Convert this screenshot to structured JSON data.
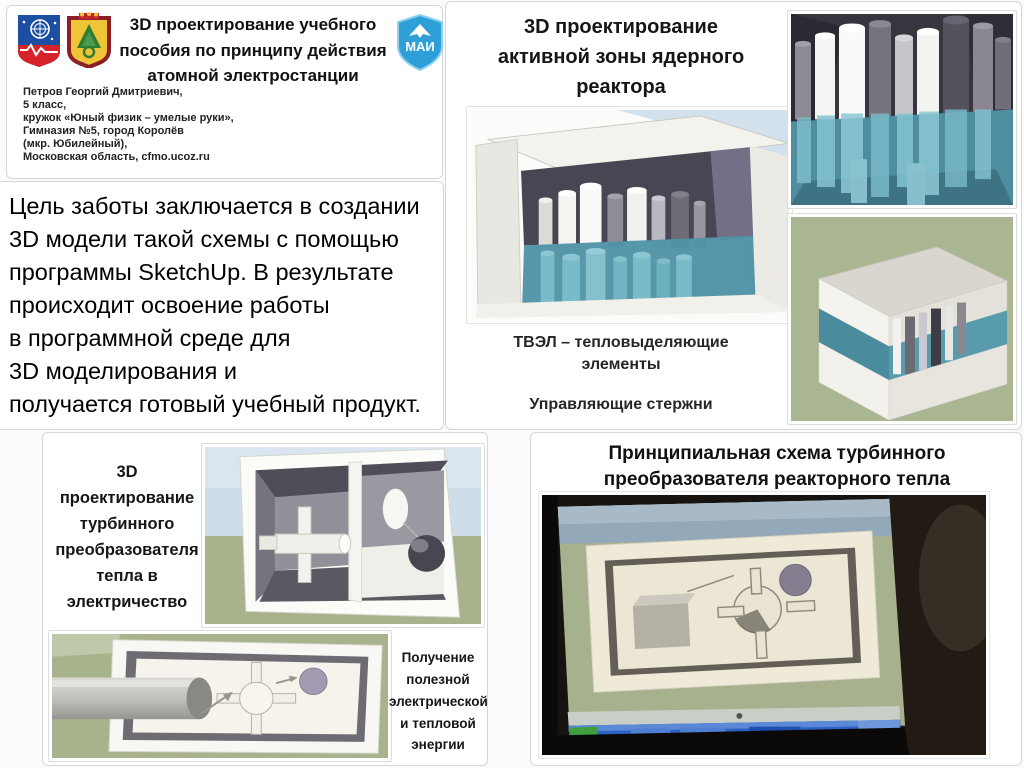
{
  "colors": {
    "teal_water": "#4f93a5",
    "teal_rod": "#7fc0cd",
    "dark_interior": "#494552",
    "sage_ground": "#a9b48f",
    "sky_blue": "#cfdde9",
    "mai_blue": "#2f9fd8",
    "taskbar_blue": "#2d62c4",
    "panel_border": "#d6d6d6"
  },
  "header": {
    "title": "3D проектирование учебного\nпособия по принципу действия\nатомной электростанции",
    "author": "Петров Георгий Дмитриевич,\n5 класс,\nкружок «Юный физик – умелые руки»,\nГимназия №5, город Королёв\n(мкр. Юбилейный),\nМосковская область, cfmo.ucoz.ru",
    "mai_label": "МАИ"
  },
  "goal": {
    "text": "Цель заботы заключается в создании\n3D модели такой схемы с помощью\nпрограммы SketchUp. В результате\nпроисходит освоение работы\nв программной среде для\n3D моделирования и\nполучается готовый учебный продукт."
  },
  "reactor_panel": {
    "title": "3D проектирование\nактивной зоны ядерного\nреактора",
    "caption_fuel": "ТВЭЛ – тепловыделяющие\nэлементы",
    "caption_rods": "Управляющие стержни"
  },
  "turbine_panel": {
    "title": "3D\nпроектирование\nтурбинного\nпреобразователя\nтепла в\nэлектричество",
    "caption": "Получение\nполезной\nэлектрической\nи тепловой\nэнергии"
  },
  "scheme_panel": {
    "title": "Принципиальная схема турбинного\nпреобразователя реакторного тепла"
  }
}
